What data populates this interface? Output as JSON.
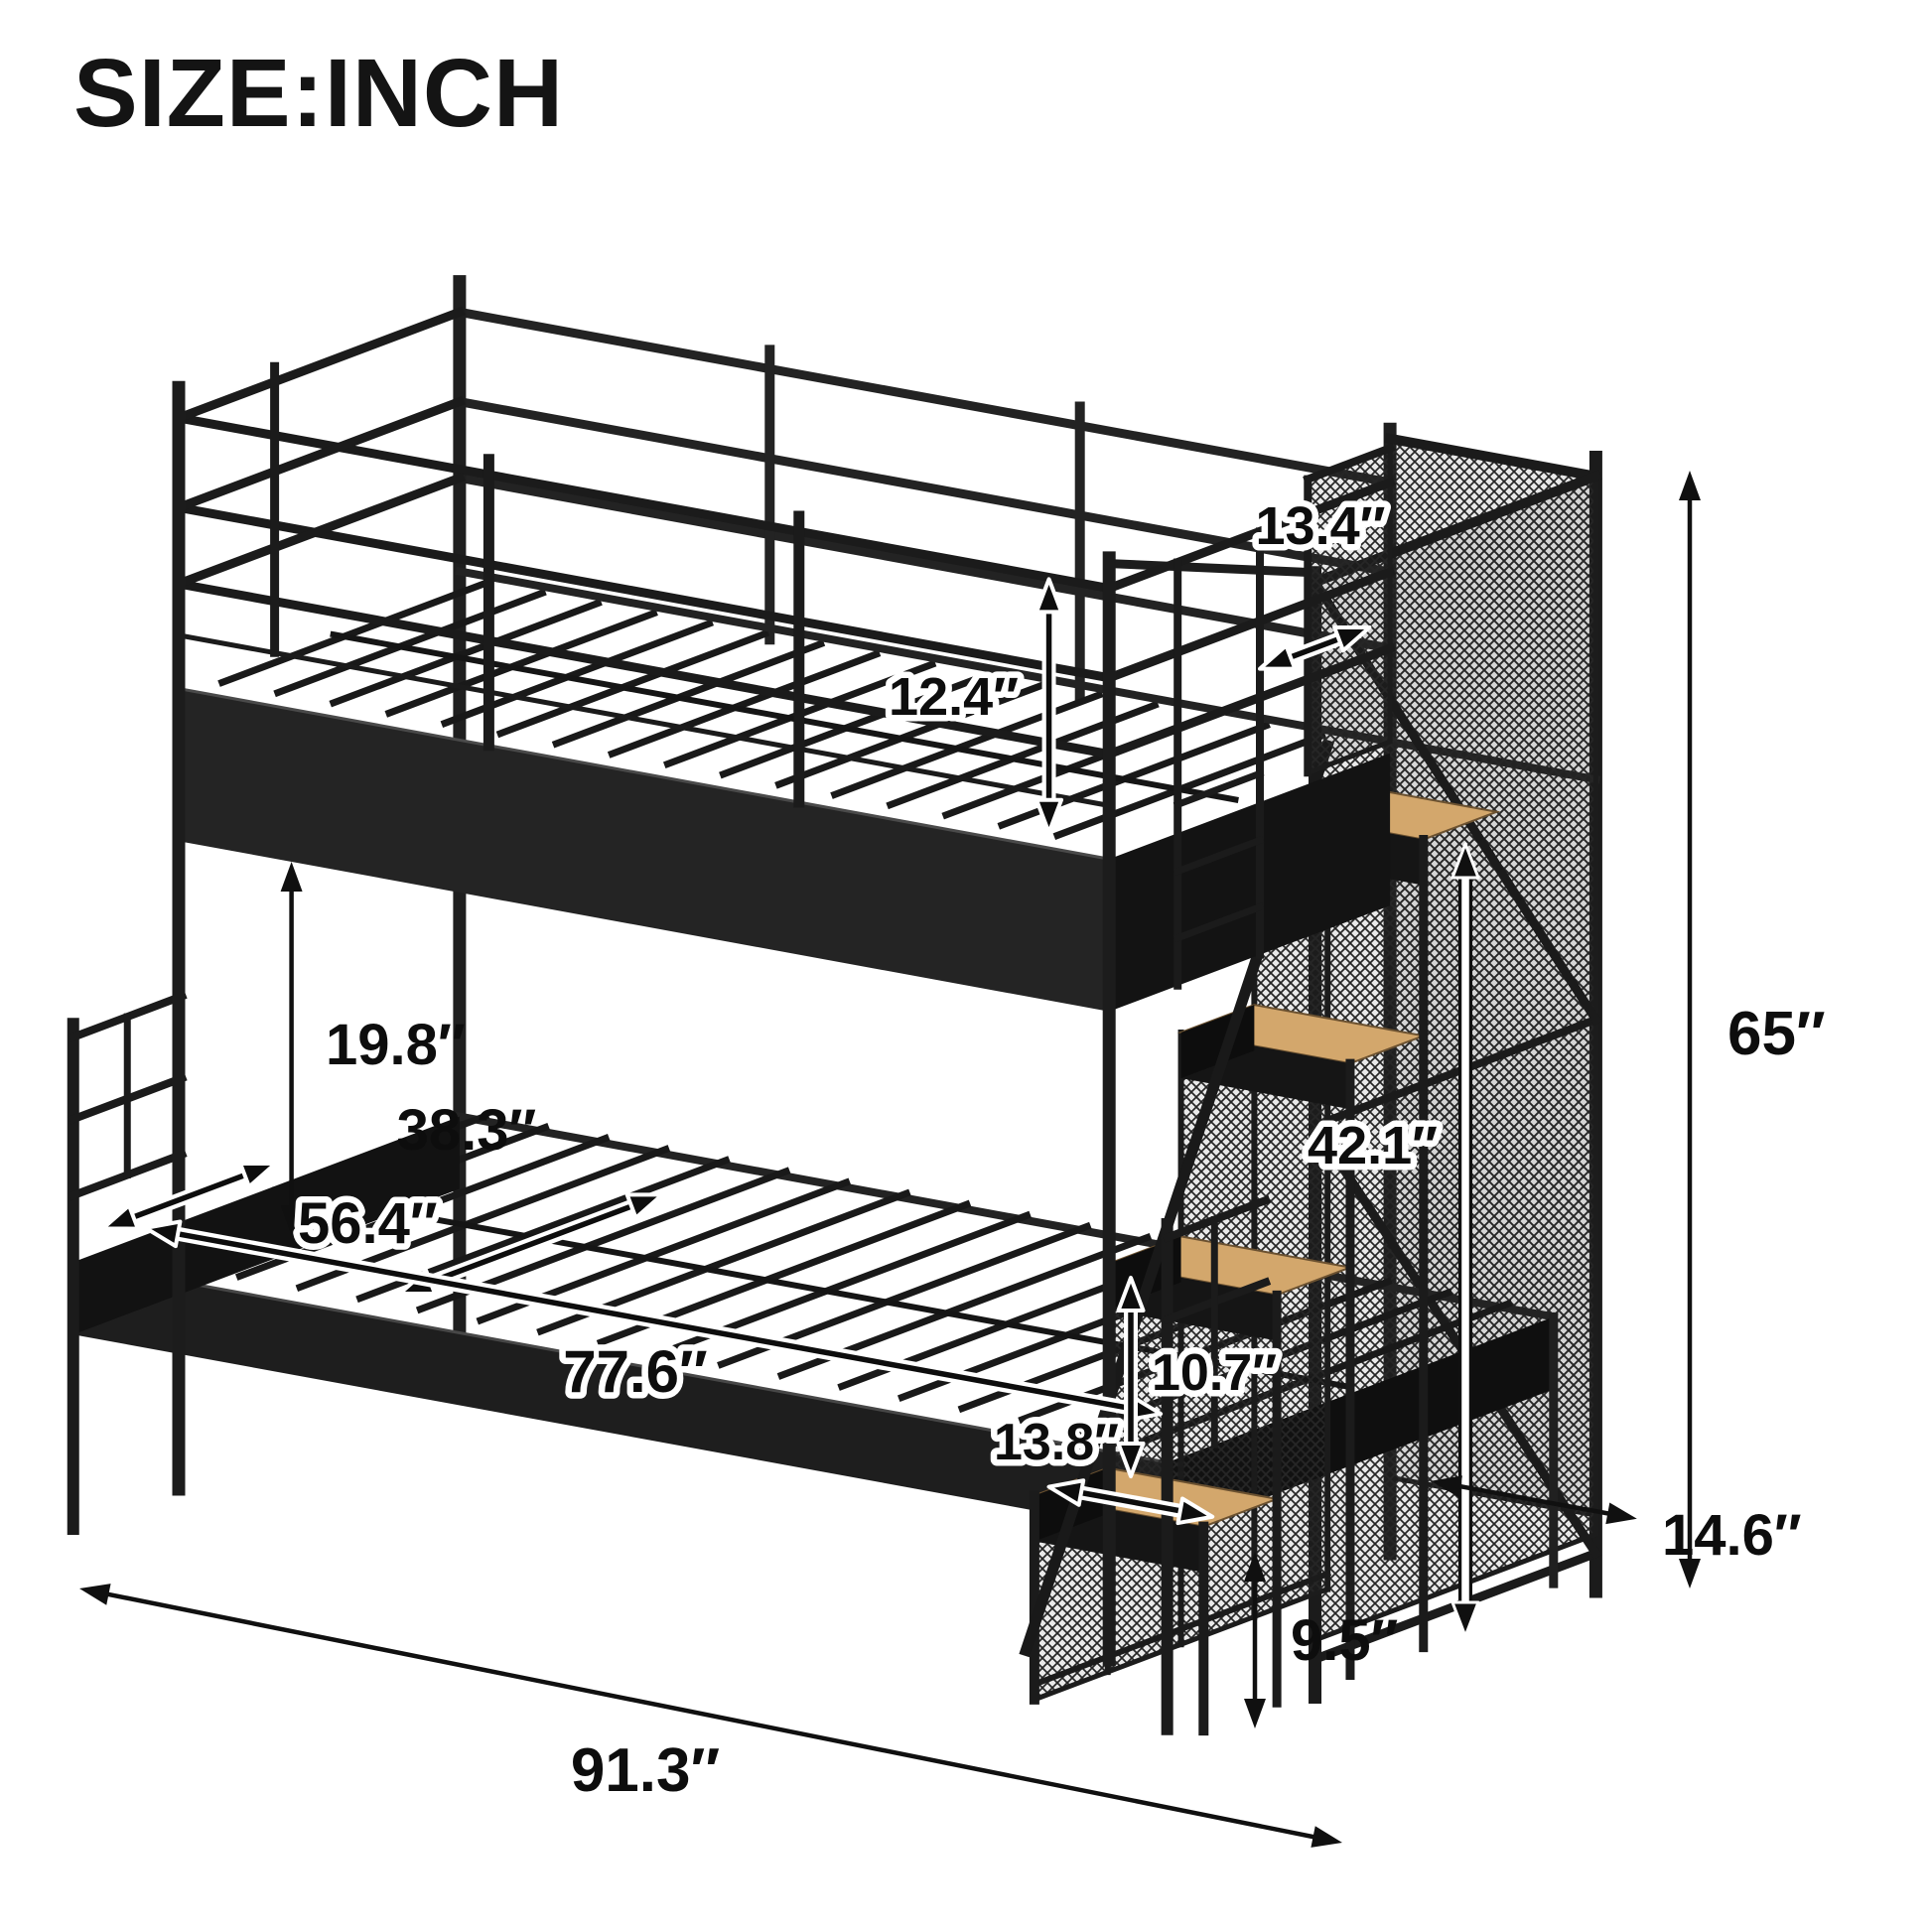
{
  "title": "SIZE:INCH",
  "unit": "inch",
  "diagram": {
    "product": "twin-over-full metal bunk bed with storage staircase",
    "frame_color": "#1c1c1c",
    "wood_color": "#d3a76c",
    "background_color": "#ffffff",
    "annotation_color": "#0d0d0d"
  },
  "dimensions": {
    "guardrail_height": "12.4″",
    "upper_bed_entry_width": "13.4″",
    "bunk_gap_height": "19.8″",
    "upper_bed_width": "38.3″",
    "lower_bed_width": "56.4″",
    "lower_bed_length": "77.6″",
    "overall_length": "91.3″",
    "overall_height": "65″",
    "staircase_height": "42.1″",
    "step_rise": "10.7″",
    "step_length": "13.8″",
    "staircase_depth": "14.6″",
    "leg_height": "9.5″"
  }
}
